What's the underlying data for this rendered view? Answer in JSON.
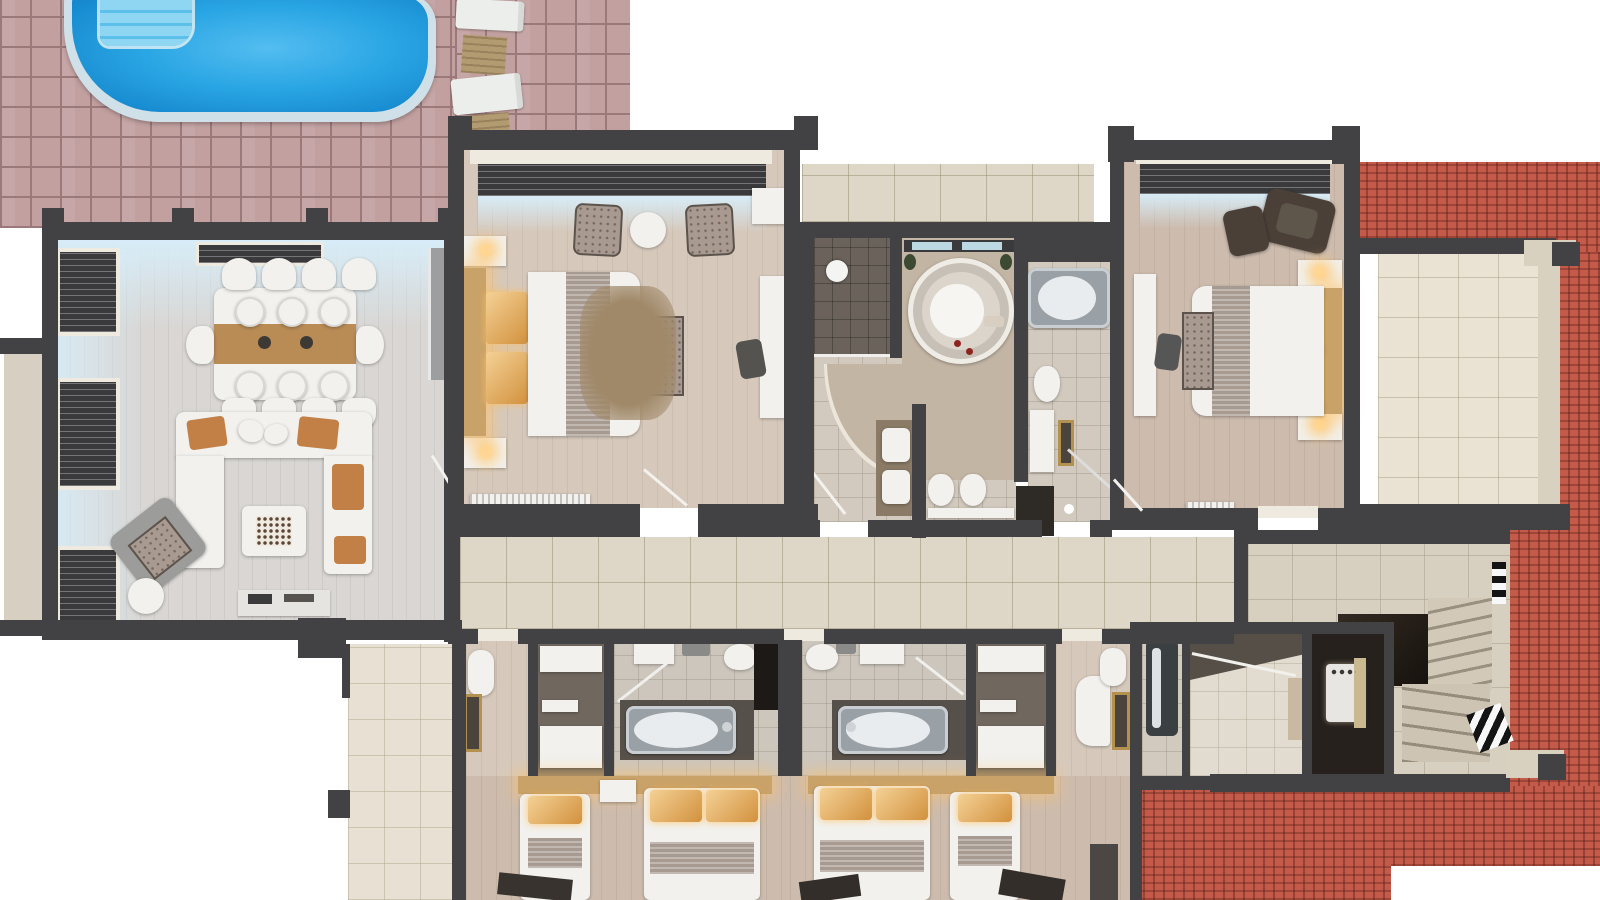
{
  "scene": {
    "view": "top-down 3d architectural floor plan render of an apartment level with pool patio",
    "areas": [
      {
        "name": "pool-patio",
        "items": [
          "swimming-pool",
          "pool-steps",
          "sun-lounger",
          "sun-lounger",
          "side-table",
          "side-table",
          "paver-tiles"
        ]
      },
      {
        "name": "living-dining-room",
        "items": [
          "dining-table",
          "eight-dining-chairs",
          "u-shaped-sofa",
          "orange-cushions",
          "coffee-table",
          "gray-armchair",
          "round-side-table",
          "sideboard",
          "kitchen-counter",
          "three-windows-with-blinds",
          "bay-window"
        ]
      },
      {
        "name": "master-bedroom",
        "items": [
          "double-bed",
          "two-nightstands",
          "bench",
          "rug",
          "two-armchairs",
          "round-table",
          "tv-console",
          "desk-chair",
          "window-with-blinds",
          "radiator"
        ]
      },
      {
        "name": "central-bathroom",
        "items": [
          "round-jacuzzi-tub",
          "shower-room",
          "double-vanity",
          "toilet",
          "bidet",
          "glass-window",
          "plants"
        ]
      },
      {
        "name": "second-bathroom",
        "items": [
          "bathtub",
          "toilet",
          "vanity-with-gold-mirror",
          "corner-shower",
          "dark-door"
        ]
      },
      {
        "name": "bedroom-right",
        "items": [
          "double-bed",
          "two-nightstands",
          "bench",
          "brown-armchair",
          "ottoman",
          "console",
          "desk-chair",
          "radiator",
          "window-with-blinds"
        ]
      },
      {
        "name": "terrace",
        "items": [
          "cream-tiled-floor",
          "beams"
        ]
      },
      {
        "name": "hallway",
        "items": [
          "beige-tiled-corridor",
          "door-sills"
        ]
      },
      {
        "name": "staircase",
        "items": [
          "tiled-landing",
          "winder-steps",
          "stair-void",
          "slatted-window",
          "slatted-window"
        ]
      },
      {
        "name": "guest-suite-left",
        "items": [
          "wardrobe-shelves",
          "bathtub",
          "sink",
          "toilet",
          "shower-glass",
          "single-bed",
          "double-bed",
          "gold-mirror",
          "robe",
          "dresser"
        ]
      },
      {
        "name": "guest-suite-right",
        "items": [
          "wardrobe-shelves",
          "bathtub",
          "sink",
          "toilet",
          "shower-glass",
          "single-bed",
          "double-bed",
          "gold-mirror",
          "vanity-sink",
          "armchairs",
          "towel-radiator"
        ]
      },
      {
        "name": "kitchenette-room",
        "items": [
          "vent-hood",
          "shelf",
          "dark-bathtub"
        ]
      },
      {
        "name": "utility-room",
        "items": [
          "boiler-unit",
          "gold-panel"
        ]
      },
      {
        "name": "roof",
        "items": [
          "terracotta-tiles"
        ]
      }
    ]
  },
  "palette": {
    "wall": "#424244",
    "paver": "#c2a0a0",
    "paver_grout": "#9b797b",
    "pool_coping": "#cfe0e8",
    "pool_water": "#2aa6e4",
    "pool_water_deep": "#0f7ec6",
    "pool_steps": "#5cc0ea",
    "lounger": "#eceeec",
    "side_table": "#b39b71",
    "roof": "#c35a4a",
    "living_floor": "#d9d6d3",
    "wood_floor": "#d6c9bc",
    "wood_floor_warm": "#cdbcae",
    "hall_tile": "#ded6c6",
    "bath_tile": "#d2cabe",
    "dark_tile": "#6b635b",
    "terrace_tile": "#eae3d3",
    "stair_tile": "#d7cfbf",
    "void": "#211c17",
    "white_furn": "#f2f1ee",
    "sofa_cushion": "#c28046",
    "wood_accent": "#b98b55",
    "gray_chair": "#9c9c9a",
    "pattern_gray": "#a89a90",
    "headboard": "#c9a269",
    "bed_runner": "#a79a90",
    "rug": "#a08969",
    "dark_brown": "#4a4038",
    "closet_dark": "#70685f",
    "appliance_dark": "#26211d",
    "gold": "#b3914f",
    "metal": "#9aa1a6",
    "window_frame": "#3a3a3c",
    "sill": "#efeadf"
  }
}
